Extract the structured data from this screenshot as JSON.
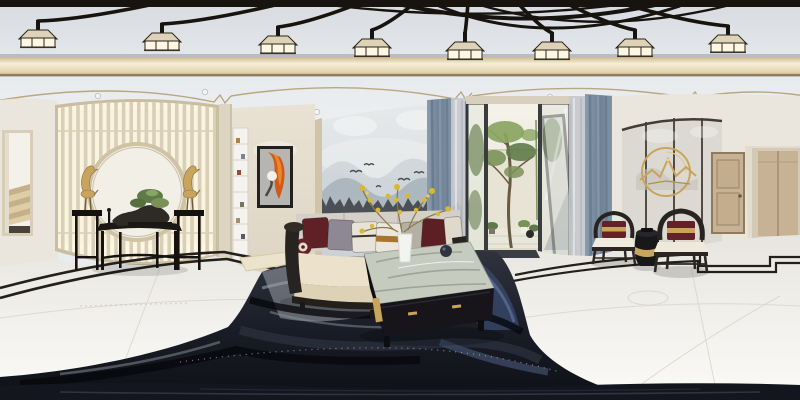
{
  "meta": {
    "kind": "equirectangular-360-panorama",
    "subject": "new-chinese-style-living-room-interior",
    "width_px": 800,
    "height_px": 400
  },
  "palette": {
    "beam": "#17130e",
    "wall": "#eae6dd",
    "wall_warm": "#e2dbcc",
    "cornice_mid": "#e9dcb9",
    "screen_slat": "#d9cfb8",
    "screen_glow": "#faf3de",
    "screen_frame": "#c9bda2",
    "gold": "#c9a45c",
    "wood_dark": "#272320",
    "cushion": "#ece2cc",
    "maroon": "#63222a",
    "drape": "#7b8ca0",
    "sheer": "#c5c8cd",
    "green": "#5f7a49",
    "green_light": "#8aa562",
    "floor": "#efede7",
    "inlay": "#23201c",
    "rug_dark": "#14161e",
    "rug_blue": "#3e5078",
    "rug_light": "#a7abb3",
    "door_wood": "#c7b295",
    "treeline": "#42464d",
    "flower": "#d9b832",
    "lamp_glow": "#fdf6e2",
    "lamp_cap": "#ded3b8",
    "vase": "#f3f3ef",
    "painting_orange": "#cf5a1a",
    "stairs": "#dfcda6",
    "mat": "#3a3d44"
  },
  "ceiling": {
    "lamps": [
      [
        38,
        33
      ],
      [
        162,
        36
      ],
      [
        278,
        39
      ],
      [
        372,
        42
      ],
      [
        465,
        45
      ],
      [
        552,
        45
      ],
      [
        635,
        42
      ],
      [
        728,
        38
      ]
    ],
    "spotlights": [
      [
        98,
        96
      ],
      [
        205,
        92
      ],
      [
        250,
        117
      ],
      [
        266,
        138
      ],
      [
        317,
        112
      ],
      [
        375,
        121
      ],
      [
        433,
        118
      ],
      [
        550,
        97
      ],
      [
        592,
        101
      ],
      [
        640,
        108
      ],
      [
        700,
        112
      ],
      [
        752,
        115
      ]
    ],
    "lamp_count": 8,
    "has_air_vent": true
  },
  "sofa": {
    "pillows": [
      {
        "x": 303,
        "w": 26,
        "y": 218,
        "rot": -4,
        "color": "#5f2126"
      },
      {
        "x": 328,
        "w": 26,
        "y": 220,
        "rot": 3,
        "color": "#8e8794"
      },
      {
        "x": 352,
        "w": 26,
        "y": 222,
        "rot": -2,
        "color": "#e7e3d8",
        "band": "#3a352f",
        "bandH": 2
      },
      {
        "x": 376,
        "w": 27,
        "y": 223,
        "rot": 2,
        "color": "#ece7dc",
        "band": "#a9742f",
        "bandH": 6
      },
      {
        "x": 402,
        "w": 22,
        "y": 222,
        "rot": -3,
        "color": "#b5b0a6"
      },
      {
        "x": 422,
        "w": 26,
        "y": 219,
        "rot": 4,
        "color": "#5c1f24"
      },
      {
        "x": 445,
        "w": 17,
        "y": 217,
        "rot": -5,
        "color": "#ded9cc"
      }
    ]
  },
  "inventory": [
    "ceiling-chandelier-black-branches",
    "square-lantern-pendants",
    "gold-cornice-band",
    "recessed-spotlights",
    "air-vent",
    "staircase-doorway",
    "lattice-moon-screen",
    "gold-crane-sculptures",
    "black-console-table",
    "bonsai-arrangement",
    "abstract-orange-painting",
    "display-shelf",
    "ink-wash-mountain-mural",
    "wood-frame-sofa",
    "bolster-pillow",
    "courtyard-glass-doors",
    "courtyard-tree",
    "gray-drapes",
    "sheer-curtains",
    "marble-coffee-table",
    "yellow-flower-vase",
    "ink-wash-area-rug",
    "marble-floor-black-inlay",
    "gold-ring-wall-art",
    "chinese-armchairs",
    "drum-stool",
    "interior-wood-doors"
  ]
}
